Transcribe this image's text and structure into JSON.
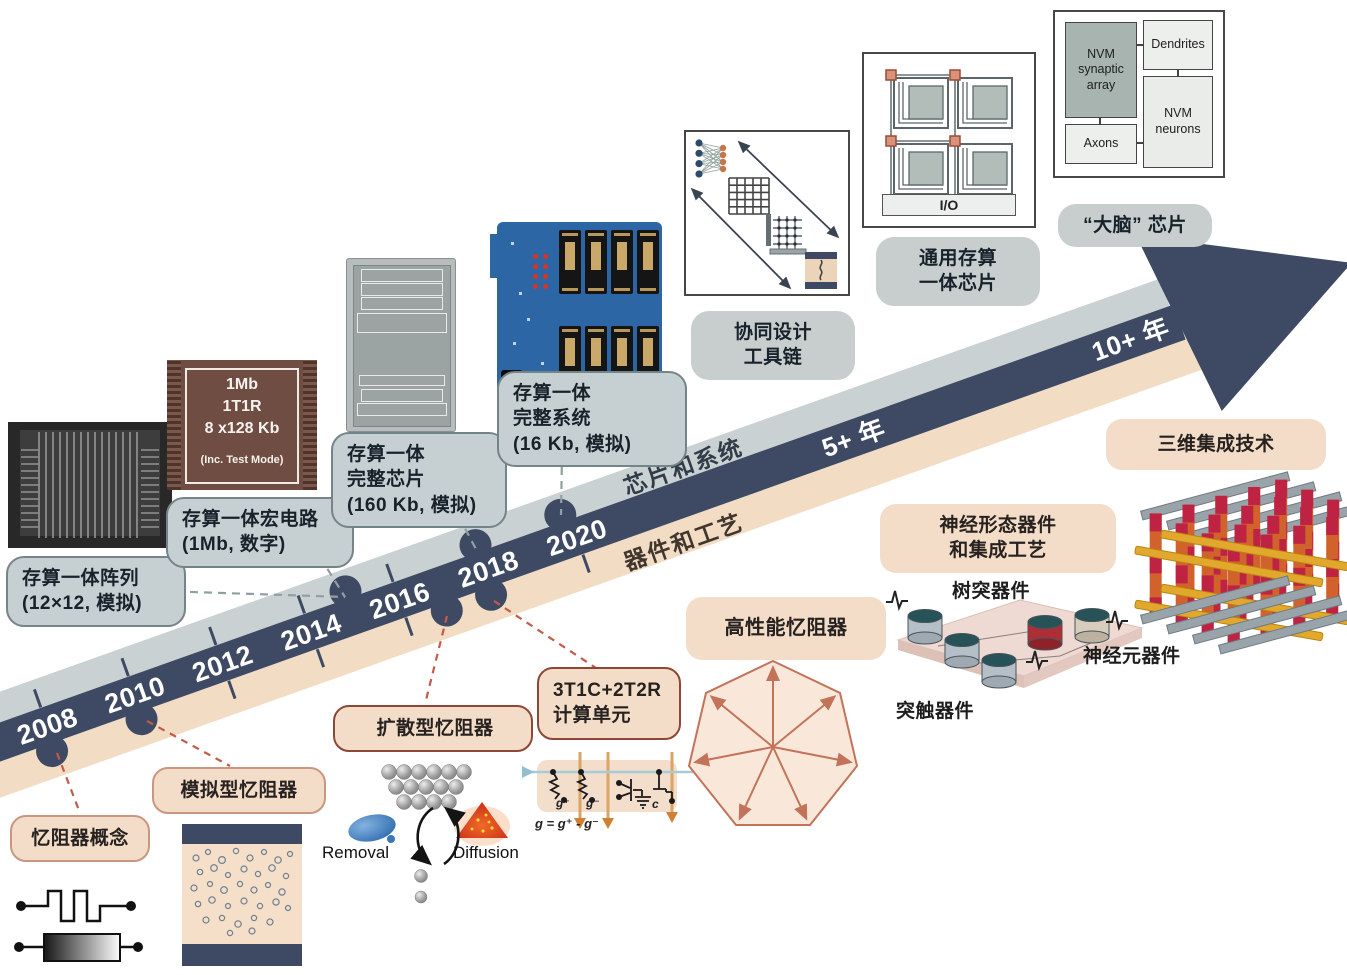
{
  "palette": {
    "arrow_navy": "#3e4a63",
    "arrow_grey_band": "#c9d1d3",
    "arrow_peach_band": "#f2dcc3",
    "grey_callout_fill": "#c6cfd1",
    "grey_callout_border": "#74858a",
    "peach_callout_fill": "#f3ddc8",
    "salmon_border": "#c79781",
    "dark_red_border": "#8e4636",
    "red_dash": "#c25b49",
    "grey_dash": "#8fa0a2",
    "heptagon_stroke": "#c3735a"
  },
  "arrow": {
    "years": [
      "2008",
      "2010",
      "2012",
      "2014",
      "2016",
      "2018",
      "2020"
    ],
    "horizon_near": "5+ 年",
    "horizon_far": "10+ 年",
    "upper_track": "芯片和系统",
    "lower_track": "器件和工艺"
  },
  "system_callouts": {
    "array_l1": "存算一体阵列",
    "array_l2": "(12×12, 模拟)",
    "macro_l1": "存算一体宏电路",
    "macro_l2": "(1Mb, 数字)",
    "chip_l1": "存算一体",
    "chip_l2": "完整芯片",
    "chip_l3": "(160 Kb, 模拟)",
    "system_l1": "存算一体",
    "system_l2": "完整系统",
    "system_l3": "(16 Kb, 模拟)",
    "codesign_l1": "协同设计",
    "codesign_l2": "工具链",
    "general_l1": "通用存算",
    "general_l2": "一体芯片",
    "brain": "“大脑” 芯片"
  },
  "device_callouts": {
    "concept": "忆阻器概念",
    "analog": "模拟型忆阻器",
    "diffusive": "扩散型忆阻器",
    "cell_l1": "3T1C+2T2R",
    "cell_l2": "计算单元",
    "high_perf": "高性能忆阻器",
    "neuro_l1": "神经形态器件",
    "neuro_l2": "和集成工艺",
    "integration_3d": "三维集成技术"
  },
  "device_labels": {
    "dendrite": "树突器件",
    "neuron": "神经元器件",
    "synapse": "突触器件"
  },
  "diffusive_labels": {
    "removal": "Removal",
    "diffusion": "Diffusion"
  },
  "cell_labels": {
    "g_plus": "g⁺",
    "g_minus": "g⁻",
    "cap": "c",
    "formula": "g = g⁺ - g⁻"
  },
  "chip_1mb": {
    "l1": "1Mb",
    "l2": "1T1R",
    "l3": "8 x128 Kb",
    "l4": "(Inc. Test Mode)"
  },
  "brain_diagram": {
    "synaptic": "NVM synaptic array",
    "dendrites": "Dendrites",
    "neurons": "NVM neurons",
    "axons": "Axons"
  },
  "tile_chip": {
    "io": "I/O"
  }
}
